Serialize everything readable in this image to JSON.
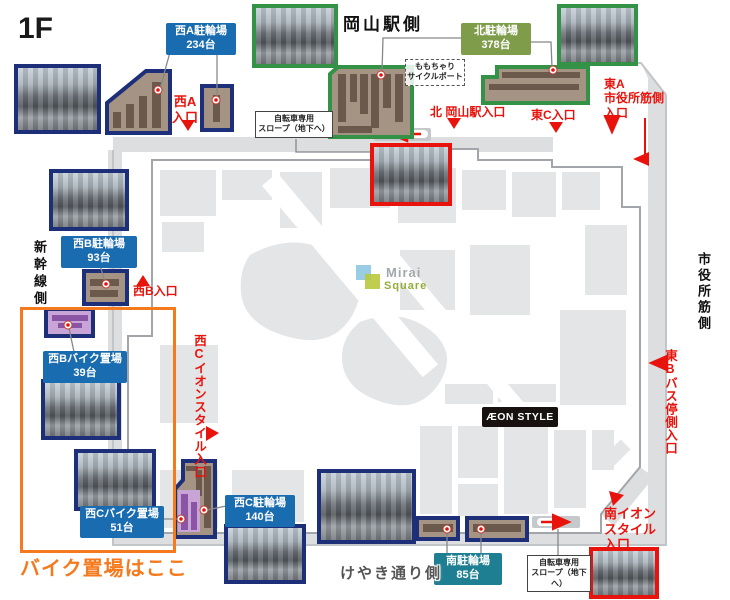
{
  "floor": "1F",
  "sides": {
    "top": "岡山駅側",
    "left": "新幹線側",
    "right": "市役所筋側",
    "bottom": "けやき通り側"
  },
  "parking": {
    "west_a": {
      "name": "西A駐輪場",
      "count": "234台"
    },
    "north": {
      "name": "北駐輪場",
      "count": "378台"
    },
    "west_b": {
      "name": "西B駐輪場",
      "count": "93台"
    },
    "west_b_bike": {
      "name": "西Bバイク置場",
      "count": "39台"
    },
    "west_c_bike": {
      "name": "西Cバイク置場",
      "count": "51台"
    },
    "west_c": {
      "name": "西C駐輪場",
      "count": "140台"
    },
    "south": {
      "name": "南駐輪場",
      "count": "85台"
    }
  },
  "entrances": {
    "west_a": {
      "line1": "西A",
      "line2": "入口"
    },
    "north": "北 岡山駅入口",
    "east_c": "東C入口",
    "east_a": {
      "line1": "東A",
      "line2": "市役所筋側",
      "line3": "入口"
    },
    "west_b": "西B入口",
    "west_c_aeon": "西Cイオンスタイル入口",
    "east_b": "東Bバス停側入口",
    "south_aeon": {
      "line1": "南イオン",
      "line2": "スタイル",
      "line3": "入口"
    }
  },
  "notes": {
    "slope": {
      "line1": "自転車専用",
      "line2": "スロープ（地下へ）"
    },
    "momochari": {
      "line1": "ももちゃり",
      "line2": "サイクルポート"
    },
    "bike_area_here": "バイク置場はここ"
  },
  "logos": {
    "mirai_line1": "Mirai",
    "mirai_line2": "Square",
    "aeon_style": "ÆON STYLE"
  },
  "colors": {
    "red": "#e8130c",
    "navy": "#1e2f7a",
    "label_blue": "#1a6cb0",
    "label_green": "#7e9c4a",
    "label_teal": "#1f7f92",
    "border_green": "#339246",
    "orange": "#f5791d",
    "rack_tan": "#a59383",
    "rack_brown": "#6b594c",
    "purple_light": "#c8a5d6",
    "purple_dark": "#8a55a5",
    "road_gray": "#dcdee0"
  }
}
